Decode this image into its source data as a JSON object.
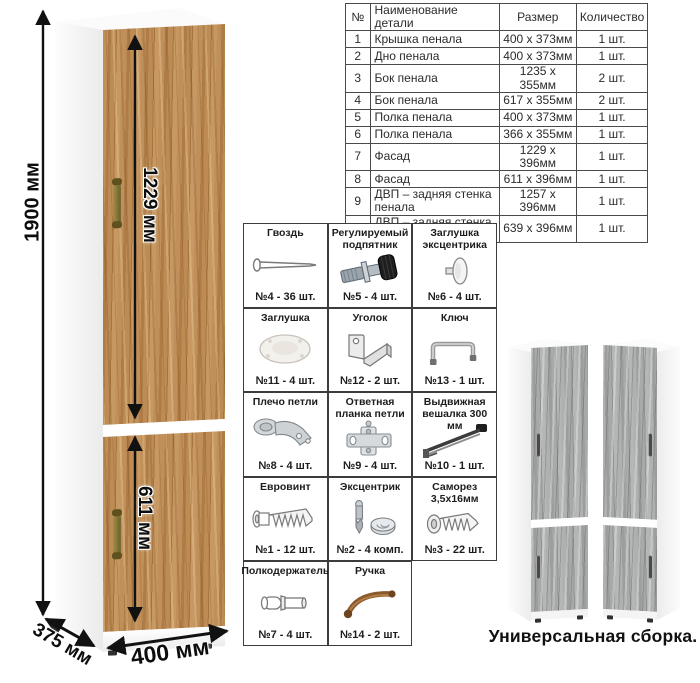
{
  "parts_table": {
    "headers": {
      "num": "№",
      "name": "Наименование детали",
      "size": "Размер",
      "qty": "Количество"
    },
    "rows": [
      {
        "num": "1",
        "name": "Крышка пенала",
        "size": "400 x 373мм",
        "qty": "1 шт."
      },
      {
        "num": "2",
        "name": "Дно пенала",
        "size": "400 x 373мм",
        "qty": "1 шт."
      },
      {
        "num": "3",
        "name": "Бок пенала",
        "size": "1235 x 355мм",
        "qty": "2 шт."
      },
      {
        "num": "4",
        "name": "Бок пенала",
        "size": "617 x 355мм",
        "qty": "2 шт."
      },
      {
        "num": "5",
        "name": "Полка пенала",
        "size": "400 x 373мм",
        "qty": "1 шт."
      },
      {
        "num": "6",
        "name": "Полка пенала",
        "size": "366 x 355мм",
        "qty": "1 шт."
      },
      {
        "num": "7",
        "name": "Фасад",
        "size": "1229 x 396мм",
        "qty": "1 шт."
      },
      {
        "num": "8",
        "name": "Фасад",
        "size": "611 x 396мм",
        "qty": "1 шт."
      },
      {
        "num": "9",
        "name": "ДВП – задняя стенка пенала",
        "size": "1257 x 396мм",
        "qty": "1 шт."
      },
      {
        "num": "10",
        "name": "ДВП – задняя стенка пенала",
        "size": "639 x 396мм",
        "qty": "1 шт."
      }
    ]
  },
  "dimensions": {
    "height": "1900 мм",
    "upper_door": "1229 мм",
    "lower_door": "611 мм",
    "depth": "375 мм",
    "width": "400 мм"
  },
  "hardware": {
    "items": [
      {
        "name": "Гвоздь",
        "count": "№4 - 36 шт.",
        "icon": "nail"
      },
      {
        "name": "Регулируемый подпятник",
        "count": "№5 - 4 шт.",
        "icon": "adjustable-foot"
      },
      {
        "name": "Заглушка эксцентрика",
        "count": "№6 - 4 шт.",
        "icon": "cam-cover"
      },
      {
        "name": "Заглушка",
        "count": "№11 - 4 шт.",
        "icon": "plug-cap"
      },
      {
        "name": "Уголок",
        "count": "№12 - 2 шт.",
        "icon": "corner-bracket"
      },
      {
        "name": "Ключ",
        "count": "№13 - 1 шт.",
        "icon": "hex-key"
      },
      {
        "name": "Плечо петли",
        "count": "№8 - 4 шт.",
        "icon": "hinge-arm"
      },
      {
        "name": "Ответная планка петли",
        "count": "№9 - 4 шт.",
        "icon": "hinge-plate"
      },
      {
        "name": "Выдвижная вешалка 300 мм",
        "count": "№10 - 1 шт.",
        "icon": "pullout-hanger"
      },
      {
        "name": "Евровинт",
        "count": "№1 - 12 шт.",
        "icon": "euro-screw"
      },
      {
        "name": "Эксцентрик",
        "count": "№2 - 4 комп.",
        "icon": "cam-lock"
      },
      {
        "name": "Саморез 3,5х16мм",
        "count": "№3 - 22 шт.",
        "icon": "self-tapping-screw"
      },
      {
        "name": "Полкодержатель",
        "count": "№7 - 4 шт.",
        "icon": "shelf-pin"
      },
      {
        "name": "Ручка",
        "count": "№14 - 2 шт.",
        "icon": "handle"
      }
    ]
  },
  "caption": "Универсальная сборка.",
  "colors": {
    "wood_base": "#b5834e",
    "wood_dark": "#a8743d",
    "wood_light": "#c79862",
    "gray_wood": "#a3a6a5",
    "table_border": "#4a4a4a",
    "handle_bronze": "#8a7a3a",
    "dimension_text": "#0d0d0d"
  }
}
